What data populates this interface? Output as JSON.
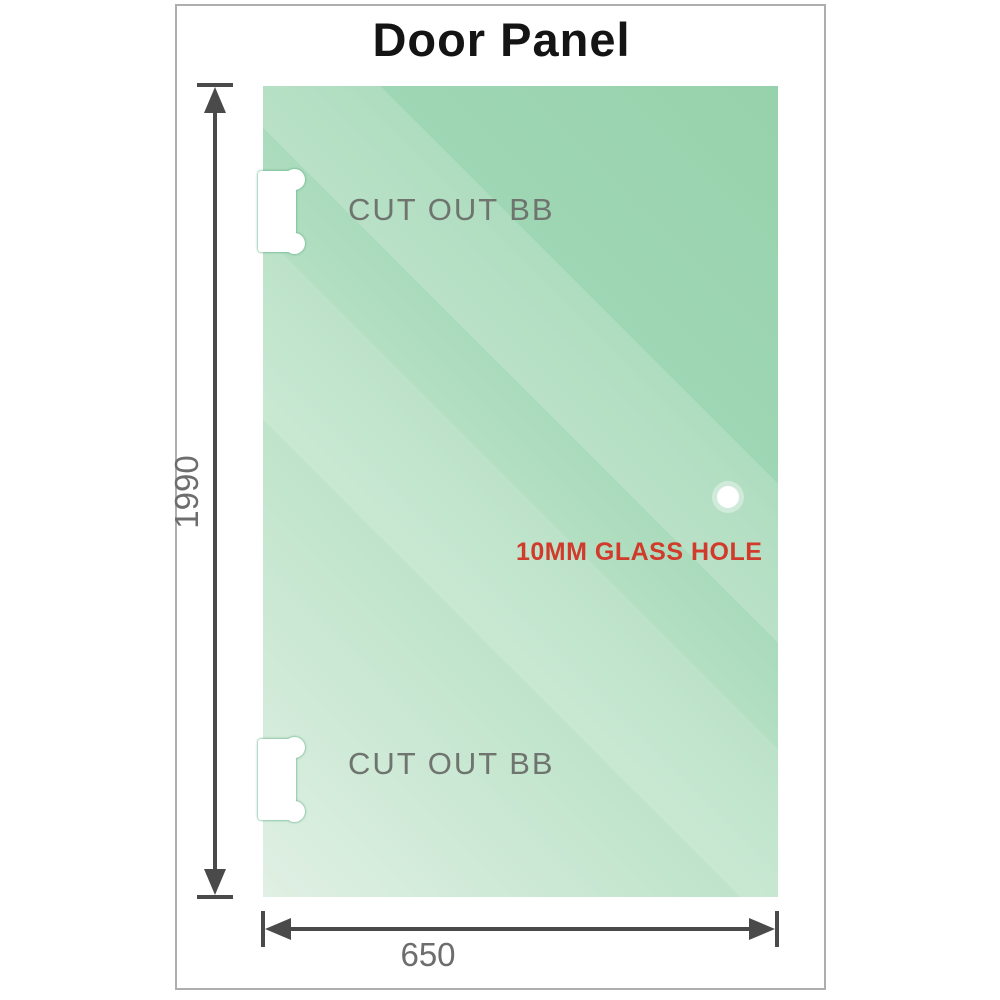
{
  "title": "Door Panel",
  "panel": {
    "cutout_top_label": "CUT OUT BB",
    "cutout_bottom_label": "CUT OUT BB",
    "glass_hole_label": "10MM GLASS HOLE",
    "height_dimension": "1990",
    "width_dimension": "650"
  },
  "colors": {
    "glass_green_dark": "#8ecfa6",
    "glass_green_light": "#e0f0e4",
    "dimension_gray": "#4a4a4a",
    "label_gray": "#6f746f",
    "dim_text_gray": "#6d6d6d",
    "hole_label_red": "#d03b2b",
    "frame_border": "#aeaeae"
  }
}
